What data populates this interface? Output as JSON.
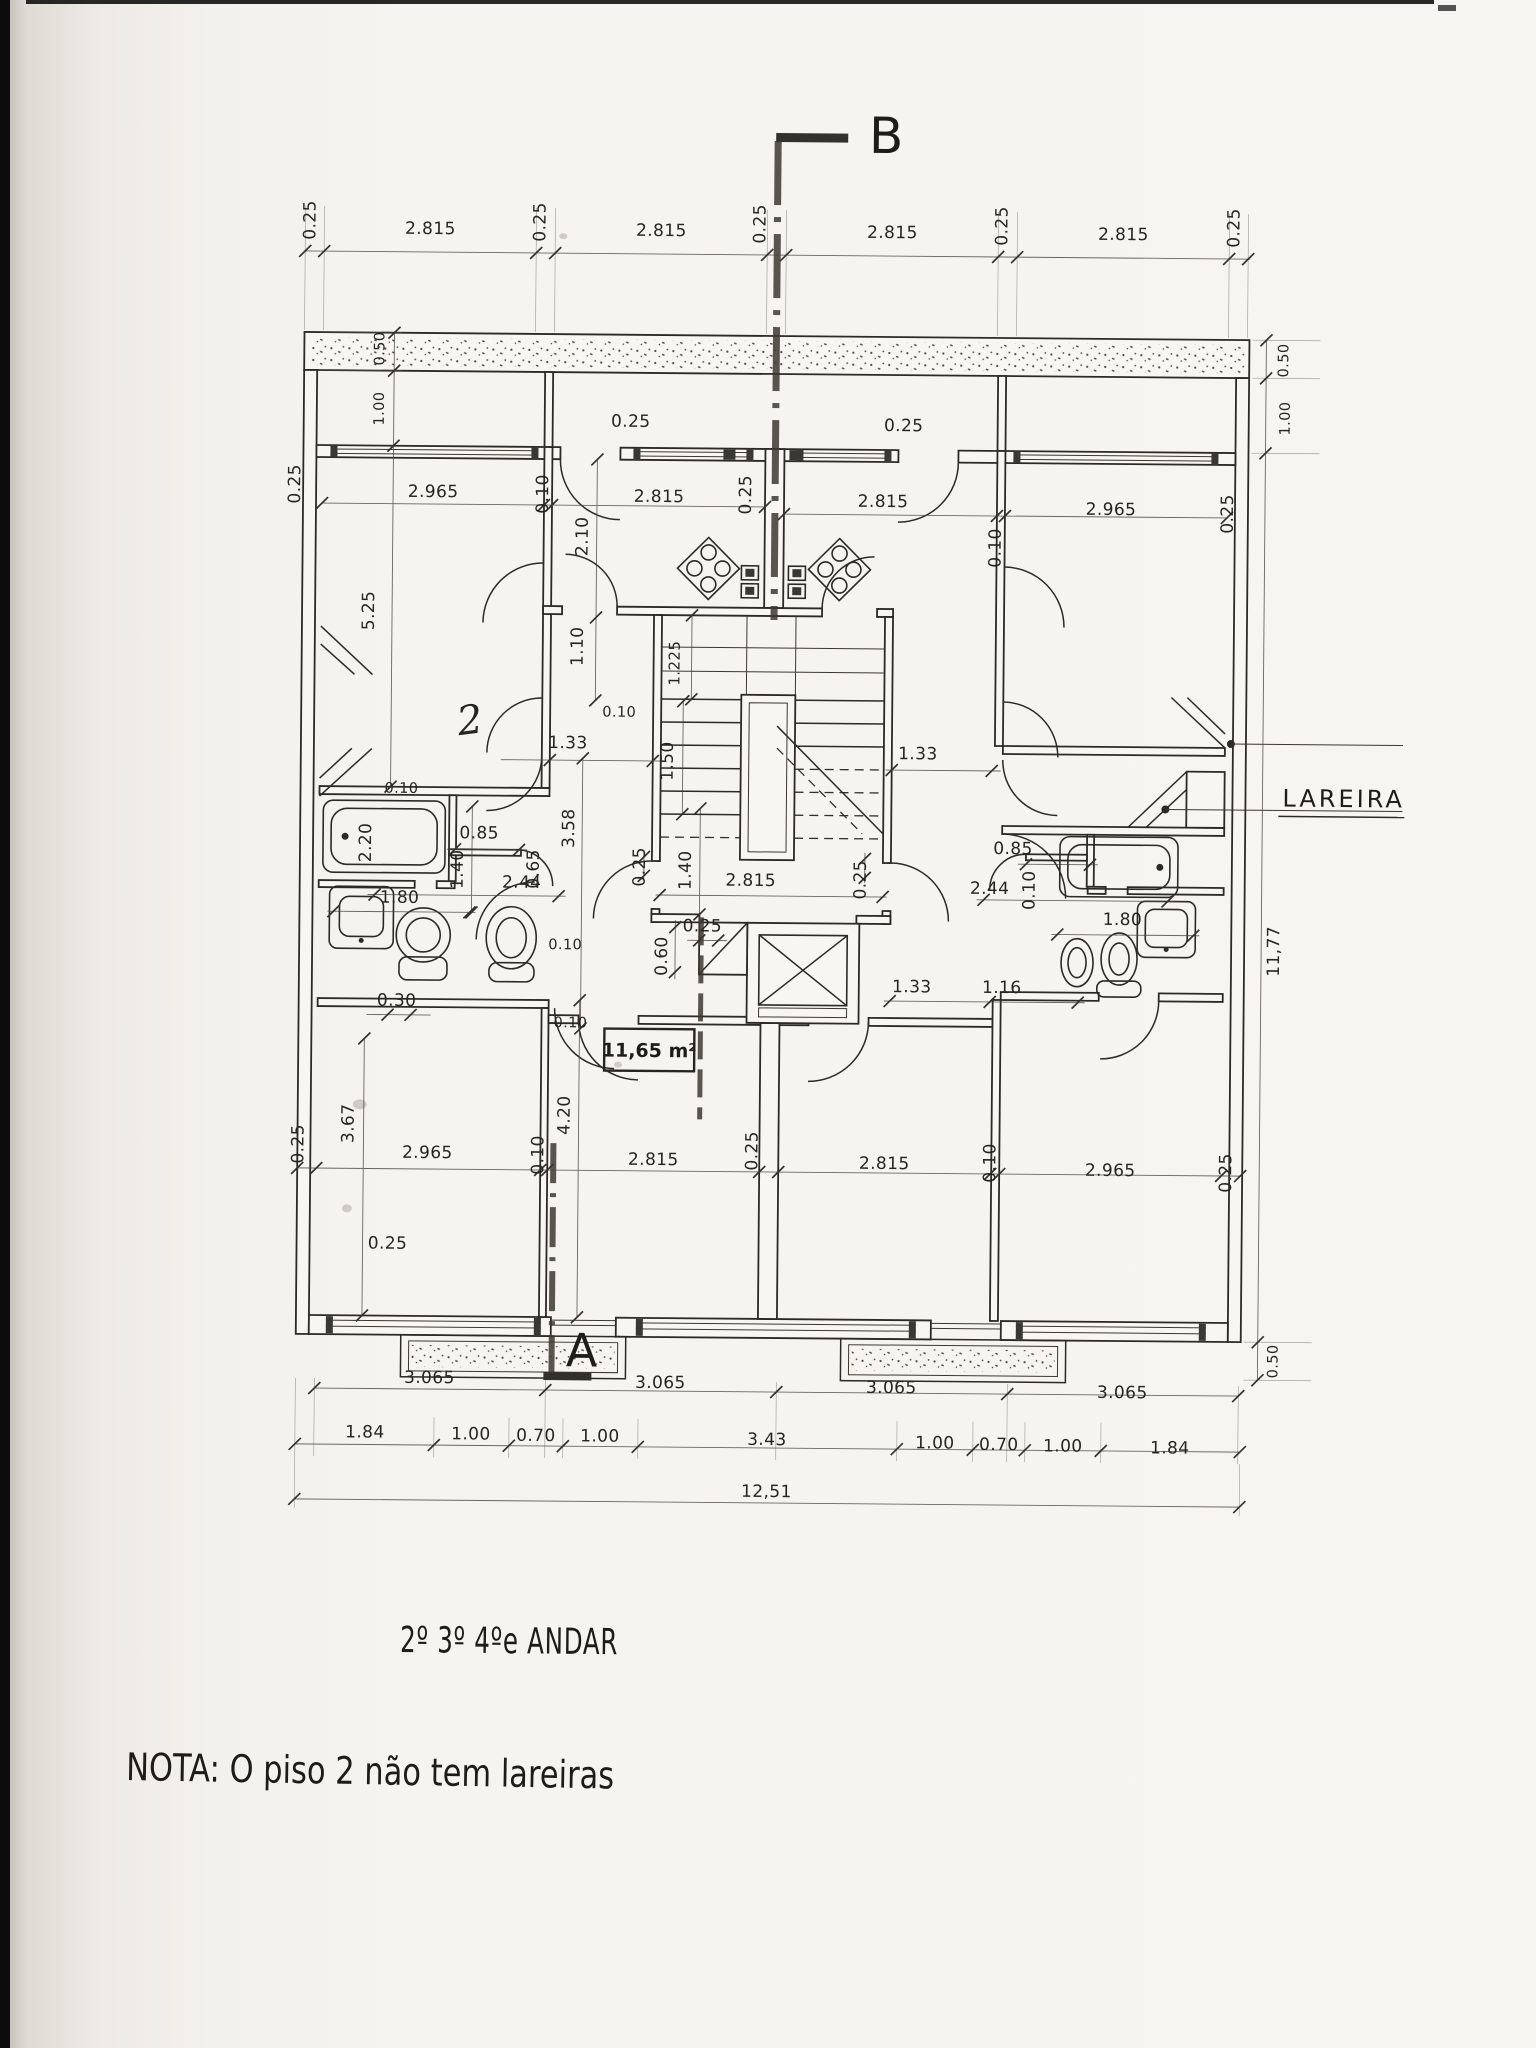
{
  "document": {
    "type": "scanned architectural floor plan",
    "title": "2º 3º 4ºe ANDAR",
    "note": "NOTA: O  piso 2  não  tem  lareiras",
    "fireplace_label": "LAREIRA",
    "room_area_label": "11,65 m²",
    "total_width_label": "12,51",
    "total_depth_label": "11,77",
    "handwritten_room_number": "2",
    "section_markers": {
      "top": "B",
      "bottom": "A"
    }
  },
  "colors": {
    "ink": "#2c2a25",
    "paper": "#f6f4f0",
    "scan_edge": "#0c0c0c"
  },
  "dimension_labels": [
    {
      "t": "0.25",
      "x": 310,
      "y": 224,
      "r": -90
    },
    {
      "t": "2.815",
      "x": 425,
      "y": 237
    },
    {
      "t": "0.25",
      "x": 540,
      "y": 224,
      "r": -90
    },
    {
      "t": "2.815",
      "x": 656,
      "y": 237
    },
    {
      "t": "0.25",
      "x": 760,
      "y": 224,
      "r": -90
    },
    {
      "t": "2.815",
      "x": 887,
      "y": 237
    },
    {
      "t": "0.25",
      "x": 1002,
      "y": 224,
      "r": -90
    },
    {
      "t": "2.815",
      "x": 1118,
      "y": 237
    },
    {
      "t": "0.25",
      "x": 1234,
      "y": 224,
      "r": -90
    },
    {
      "t": "0.50",
      "x": 380,
      "y": 352,
      "r": -90,
      "s": 14
    },
    {
      "t": "1.00",
      "x": 380,
      "y": 412,
      "r": -90,
      "s": 14
    },
    {
      "t": "0.25",
      "x": 297,
      "y": 488,
      "r": -90
    },
    {
      "t": "2.965",
      "x": 430,
      "y": 500
    },
    {
      "t": "0.10",
      "x": 545,
      "y": 496,
      "r": -90
    },
    {
      "t": "2.815",
      "x": 656,
      "y": 503
    },
    {
      "t": "0.25",
      "x": 627,
      "y": 428
    },
    {
      "t": "0.25",
      "x": 748,
      "y": 495,
      "r": -90
    },
    {
      "t": "2.815",
      "x": 880,
      "y": 506
    },
    {
      "t": "0.10",
      "x": 998,
      "y": 546,
      "r": -90
    },
    {
      "t": "2.965",
      "x": 1108,
      "y": 512
    },
    {
      "t": "0.25",
      "x": 1230,
      "y": 510,
      "r": -90
    },
    {
      "t": "0.25",
      "x": 900,
      "y": 430
    },
    {
      "t": "0.50",
      "x": 1284,
      "y": 356,
      "r": -90,
      "s": 14
    },
    {
      "t": "1.00",
      "x": 1286,
      "y": 414,
      "r": -90,
      "s": 14
    },
    {
      "t": "11,77",
      "x": 1280,
      "y": 947,
      "r": -90
    },
    {
      "t": "0.50",
      "x": 1282,
      "y": 1357,
      "r": -90,
      "s": 14
    },
    {
      "t": "2.10",
      "x": 585,
      "y": 538,
      "r": -90
    },
    {
      "t": "1.10",
      "x": 581,
      "y": 648,
      "r": -90
    },
    {
      "t": "5.25",
      "x": 372,
      "y": 614,
      "r": -90
    },
    {
      "t": "1.225",
      "x": 678,
      "y": 664,
      "r": -90,
      "s": 15
    },
    {
      "t": "1.50",
      "x": 672,
      "y": 762,
      "r": -90
    },
    {
      "t": "1.33",
      "x": 567,
      "y": 750
    },
    {
      "t": "1.33",
      "x": 917,
      "y": 758
    },
    {
      "t": "0.10",
      "x": 618,
      "y": 718,
      "s": 14
    },
    {
      "t": "3.58",
      "x": 574,
      "y": 830,
      "r": -90
    },
    {
      "t": "0.10",
      "x": 401,
      "y": 796,
      "s": 14
    },
    {
      "t": "2.20",
      "x": 371,
      "y": 846,
      "r": -90
    },
    {
      "t": "0.85",
      "x": 479,
      "y": 841
    },
    {
      "t": "0.65",
      "x": 539,
      "y": 871,
      "r": -90
    },
    {
      "t": "2.44",
      "x": 522,
      "y": 890
    },
    {
      "t": "1.40",
      "x": 463,
      "y": 872,
      "r": -90
    },
    {
      "t": "1.80",
      "x": 400,
      "y": 906
    },
    {
      "t": "0.30",
      "x": 398,
      "y": 1009
    },
    {
      "t": "0.25",
      "x": 645,
      "y": 868,
      "r": -90
    },
    {
      "t": "1.40",
      "x": 691,
      "y": 871,
      "r": -90
    },
    {
      "t": "2.815",
      "x": 751,
      "y": 886
    },
    {
      "t": "0.25",
      "x": 703,
      "y": 932
    },
    {
      "t": "0.60",
      "x": 668,
      "y": 957,
      "r": -90
    },
    {
      "t": "0.10",
      "x": 566,
      "y": 951,
      "s": 14
    },
    {
      "t": "0.10",
      "x": 572,
      "y": 1029,
      "s": 14
    },
    {
      "t": "0.25",
      "x": 866,
      "y": 879,
      "r": -90
    },
    {
      "t": "0.85",
      "x": 1013,
      "y": 852
    },
    {
      "t": "0.10",
      "x": 1035,
      "y": 888,
      "r": -90
    },
    {
      "t": "2.44",
      "x": 990,
      "y": 892
    },
    {
      "t": "1.80",
      "x": 1123,
      "y": 922
    },
    {
      "t": "1.33",
      "x": 913,
      "y": 991
    },
    {
      "t": "1.16",
      "x": 1003,
      "y": 991
    },
    {
      "t": "0.25",
      "x": 306,
      "y": 1148,
      "r": -90
    },
    {
      "t": "3.67",
      "x": 356,
      "y": 1127,
      "r": -90
    },
    {
      "t": "2.965",
      "x": 430,
      "y": 1161
    },
    {
      "t": "0.10",
      "x": 546,
      "y": 1157,
      "r": -90
    },
    {
      "t": "4.20",
      "x": 572,
      "y": 1117,
      "r": -90
    },
    {
      "t": "2.815",
      "x": 656,
      "y": 1166
    },
    {
      "t": "0.25",
      "x": 760,
      "y": 1151,
      "r": -90
    },
    {
      "t": "2.815",
      "x": 887,
      "y": 1168
    },
    {
      "t": "0.10",
      "x": 998,
      "y": 1161,
      "r": -90
    },
    {
      "t": "2.965",
      "x": 1113,
      "y": 1173
    },
    {
      "t": "0.25",
      "x": 1234,
      "y": 1169,
      "r": -90
    },
    {
      "t": "0.25",
      "x": 391,
      "y": 1252
    },
    {
      "t": "3.065",
      "x": 434,
      "y": 1386
    },
    {
      "t": "3.065",
      "x": 665,
      "y": 1389
    },
    {
      "t": "3.065",
      "x": 896,
      "y": 1392
    },
    {
      "t": "3.065",
      "x": 1127,
      "y": 1395
    },
    {
      "t": "1.84",
      "x": 370,
      "y": 1441
    },
    {
      "t": "1.00",
      "x": 476,
      "y": 1442
    },
    {
      "t": "0.70",
      "x": 541,
      "y": 1443
    },
    {
      "t": "1.00",
      "x": 605,
      "y": 1443
    },
    {
      "t": "3.43",
      "x": 772,
      "y": 1445
    },
    {
      "t": "1.00",
      "x": 940,
      "y": 1447
    },
    {
      "t": "0.70",
      "x": 1004,
      "y": 1448
    },
    {
      "t": "1.00",
      "x": 1068,
      "y": 1449
    },
    {
      "t": "1.84",
      "x": 1175,
      "y": 1450
    },
    {
      "t": "12,51",
      "x": 772,
      "y": 1497
    }
  ]
}
